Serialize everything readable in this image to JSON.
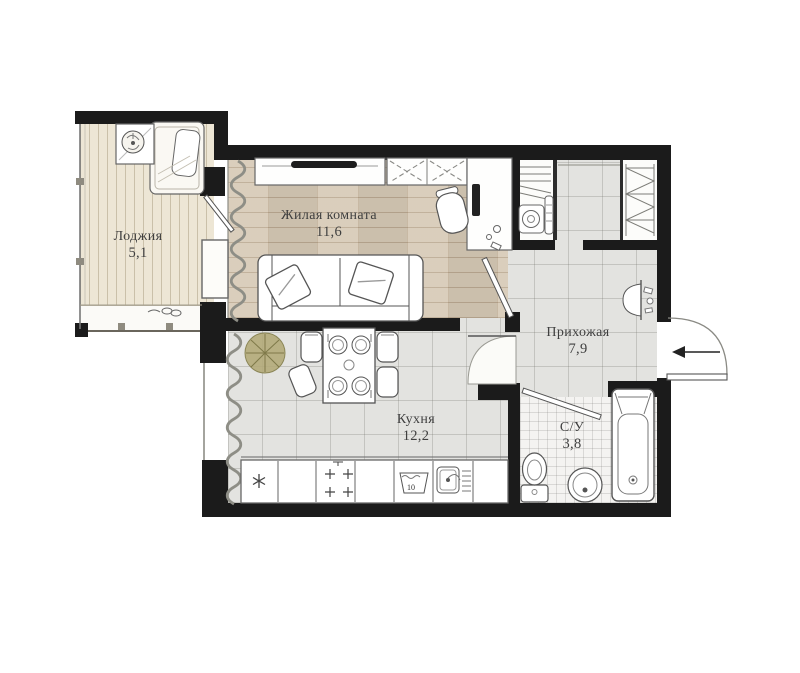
{
  "plan": {
    "rooms": [
      {
        "id": "loggia",
        "name": "Лоджия",
        "area": "5,1"
      },
      {
        "id": "living",
        "name": "Жилая комната",
        "area": "11,6"
      },
      {
        "id": "hallway",
        "name": "Прихожая",
        "area": "7,9"
      },
      {
        "id": "kitchen",
        "name": "Кухня",
        "area": "12,2"
      },
      {
        "id": "bathroom",
        "name": "С/У",
        "area": "3,8"
      }
    ],
    "washer_symbol": "10",
    "colors": {
      "wall": "#1b1b1b",
      "wood_floor": "#d6c9b5",
      "loggia_floor": "#ede6d5",
      "tile_floor": "#e3e3e0",
      "bath_floor": "#f4f3f1",
      "label_text": "#3f3f3f",
      "plant_green": "#b3aa79"
    }
  }
}
